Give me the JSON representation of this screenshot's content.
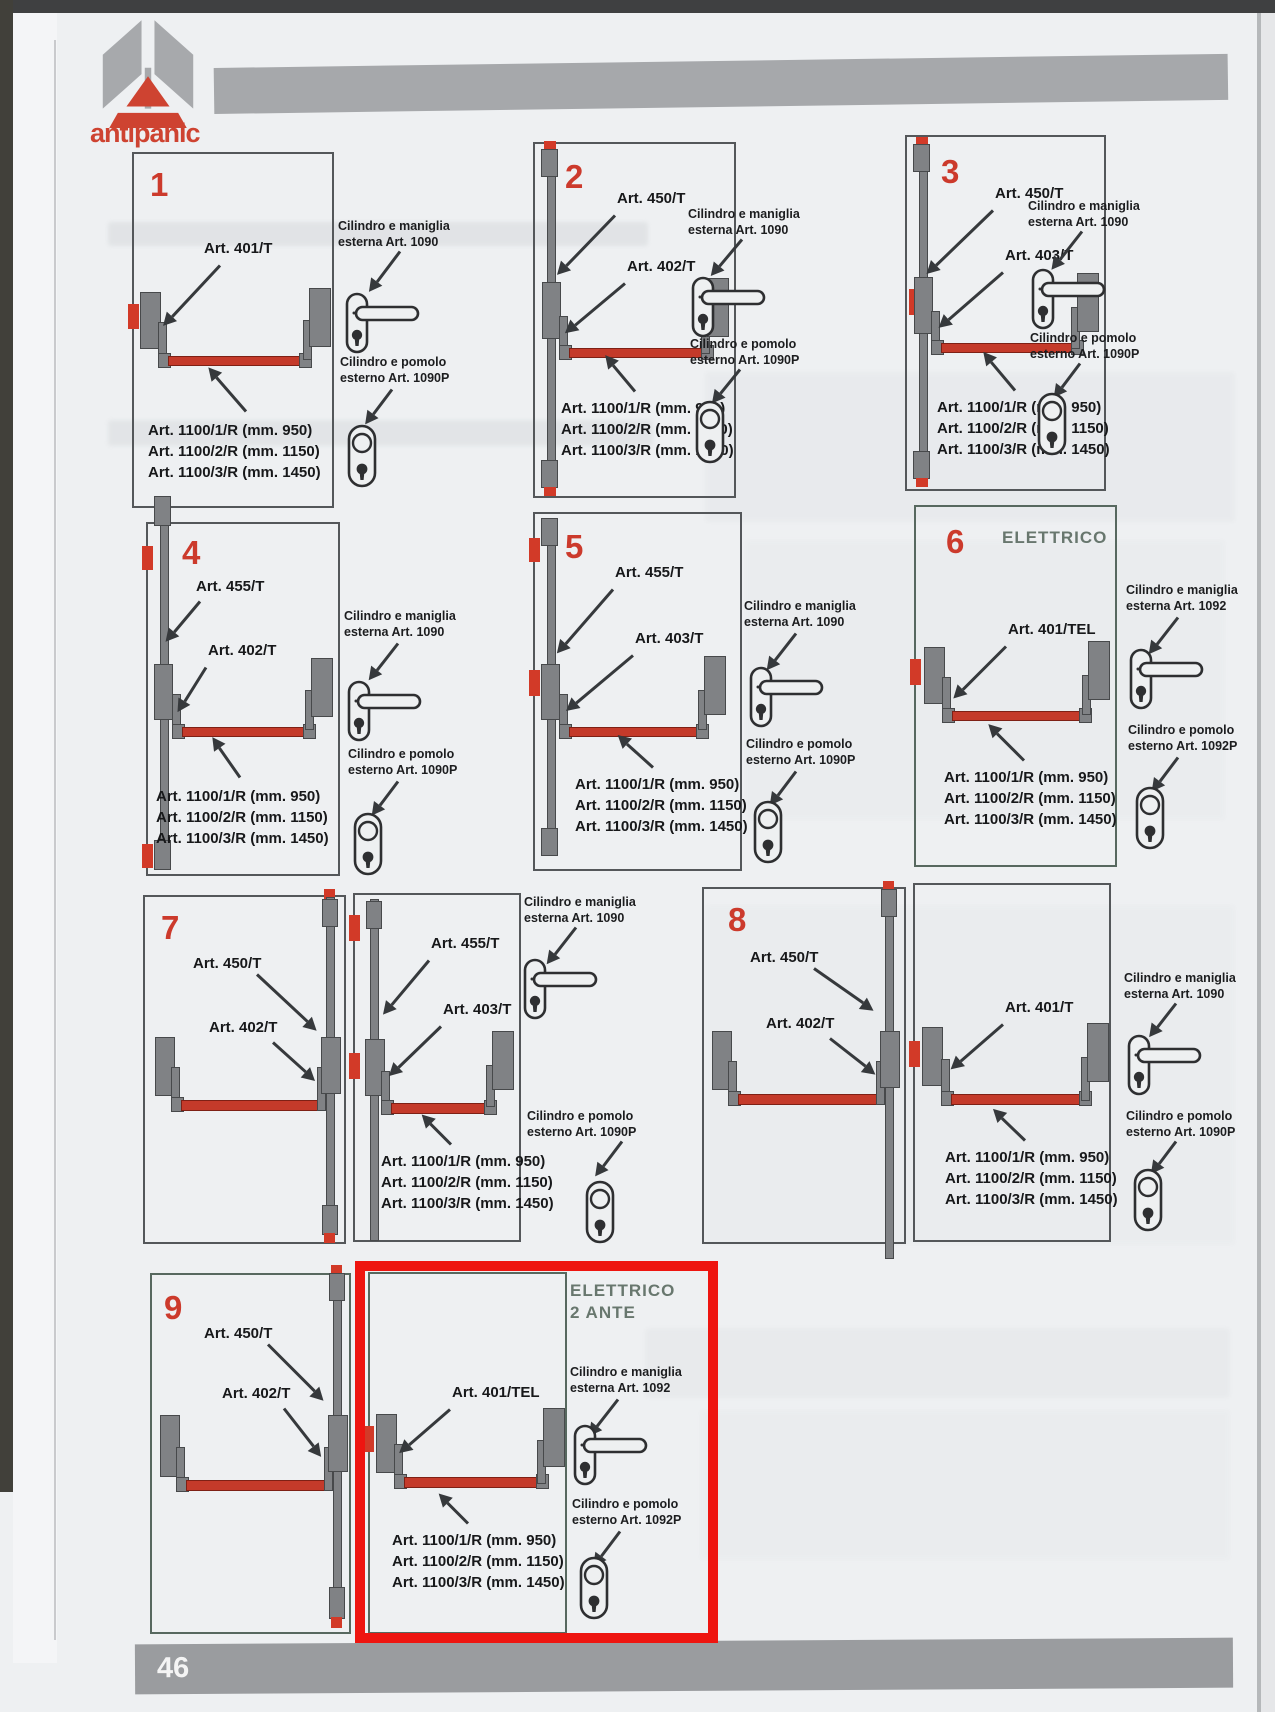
{
  "page": {
    "number": "46",
    "brand": "antipanic"
  },
  "colors": {
    "accent_red": "#cc3a2c",
    "highlight_red": "#ee1510",
    "panel_green": "#57685f",
    "bar_red": "#c43a2a",
    "gray": "#a7a9ac"
  },
  "sizes": [
    "Art. 1100/1/R (mm. 950)",
    "Art. 1100/2/R (mm. 1150)",
    "Art. 1100/3/R (mm. 1450)"
  ],
  "cylinders": {
    "maniglia_1090": [
      "Cilindro e maniglia",
      "esterna Art. 1090"
    ],
    "pomolo_1090": [
      "Cilindro e pomolo",
      "esterno Art. 1090P"
    ],
    "maniglia_1092": [
      "Cilindro e maniglia",
      "esterna Art. 1092"
    ],
    "pomolo_1092": [
      "Cilindro e pomolo",
      "esterno Art. 1092P"
    ]
  },
  "panels": {
    "p1": {
      "num": "1",
      "a": "Art. 401/T"
    },
    "p2": {
      "num": "2",
      "a": "Art. 450/T",
      "b": "Art. 402/T"
    },
    "p3": {
      "num": "3",
      "a": "Art. 450/T",
      "b": "Art. 403/T"
    },
    "p4": {
      "num": "4",
      "a": "Art. 455/T",
      "b": "Art. 402/T"
    },
    "p5": {
      "num": "5",
      "a": "Art. 455/T",
      "b": "Art. 403/T"
    },
    "p6": {
      "num": "6",
      "title": "ELETTRICO",
      "a": "Art. 401/TEL"
    },
    "p7": {
      "num": "7",
      "left_a": "Art. 450/T",
      "left_b": "Art. 402/T",
      "right_a": "Art. 455/T",
      "right_b": "Art. 403/T"
    },
    "p8": {
      "num": "8",
      "left_a": "Art. 450/T",
      "left_b": "Art. 402/T",
      "right_a": "Art. 401/T"
    },
    "p9": {
      "num": "9",
      "left_a": "Art. 450/T",
      "left_b": "Art. 402/T"
    },
    "e2a": {
      "title_line1": "ELETTRICO",
      "title_line2": "2 ANTE",
      "a": "Art. 401/TEL"
    }
  }
}
